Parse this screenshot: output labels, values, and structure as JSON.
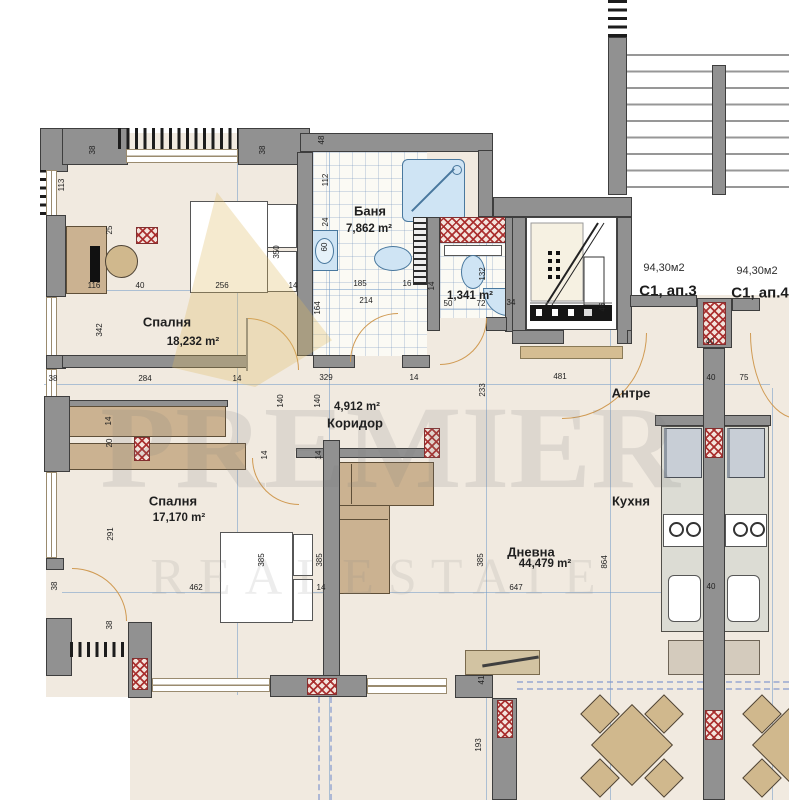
{
  "watermark": {
    "brand": "PREMIER",
    "tagline": "REALESTATE"
  },
  "apartments": [
    {
      "area": "94,30м2",
      "unit": "С1, ап.3"
    },
    {
      "area": "94,30м2",
      "unit": "С1, ап.4"
    }
  ],
  "rooms": [
    {
      "id": "bedroom-1",
      "name": "Спалня",
      "area": "18,232 m²"
    },
    {
      "id": "bathroom",
      "name": "Баня",
      "area": "7,862 m²"
    },
    {
      "id": "wc",
      "name": "",
      "area": "1,341 m²"
    },
    {
      "id": "corridor",
      "name": "Коридор",
      "area": "4,912 m²"
    },
    {
      "id": "bedroom-2",
      "name": "Спалня",
      "area": "17,170 m²"
    },
    {
      "id": "living-room",
      "name": "Дневна",
      "area": "44,479 m²"
    },
    {
      "id": "kitchen",
      "name": "Кухня",
      "area": ""
    },
    {
      "id": "entry",
      "name": "Антре",
      "area": ""
    }
  ],
  "colors": {
    "wall": "#919191",
    "floor": "#f1eae0",
    "hatch_red": "#a82a2a",
    "fixture_blue": "#cfe4f4",
    "furniture_tan": "#cbb291",
    "door_arc": "#d09a52",
    "guide_blue": "#739bc8",
    "watermark_gold": "#dfb95f"
  },
  "dimensions": [
    {
      "t": "38",
      "x": 93,
      "y": 150,
      "v": 1
    },
    {
      "t": "38",
      "x": 263,
      "y": 150,
      "v": 1
    },
    {
      "t": "48",
      "x": 322,
      "y": 140,
      "v": 1
    },
    {
      "t": "113",
      "x": 62,
      "y": 185,
      "v": 1
    },
    {
      "t": "25",
      "x": 110,
      "y": 230,
      "v": 1
    },
    {
      "t": "116",
      "x": 94,
      "y": 286
    },
    {
      "t": "40",
      "x": 140,
      "y": 286
    },
    {
      "t": "256",
      "x": 222,
      "y": 286
    },
    {
      "t": "350",
      "x": 277,
      "y": 252,
      "v": 1
    },
    {
      "t": "14",
      "x": 293,
      "y": 286
    },
    {
      "t": "342",
      "x": 100,
      "y": 330,
      "v": 1
    },
    {
      "t": "38",
      "x": 53,
      "y": 379
    },
    {
      "t": "284",
      "x": 145,
      "y": 379
    },
    {
      "t": "14",
      "x": 237,
      "y": 379
    },
    {
      "t": "329",
      "x": 326,
      "y": 378
    },
    {
      "t": "14",
      "x": 414,
      "y": 378
    },
    {
      "t": "481",
      "x": 560,
      "y": 377
    },
    {
      "t": "233",
      "x": 483,
      "y": 390,
      "v": 1
    },
    {
      "t": "40",
      "x": 711,
      "y": 378
    },
    {
      "t": "75",
      "x": 744,
      "y": 378
    },
    {
      "t": "112",
      "x": 326,
      "y": 180,
      "v": 1
    },
    {
      "t": "24",
      "x": 326,
      "y": 222,
      "v": 1
    },
    {
      "t": "60",
      "x": 325,
      "y": 247,
      "v": 1
    },
    {
      "t": "185",
      "x": 360,
      "y": 284
    },
    {
      "t": "16",
      "x": 407,
      "y": 284
    },
    {
      "t": "214",
      "x": 366,
      "y": 301
    },
    {
      "t": "132",
      "x": 483,
      "y": 274,
      "v": 1
    },
    {
      "t": "14",
      "x": 432,
      "y": 286,
      "v": 1
    },
    {
      "t": "50",
      "x": 448,
      "y": 304
    },
    {
      "t": "72",
      "x": 481,
      "y": 304
    },
    {
      "t": "34",
      "x": 511,
      "y": 303
    },
    {
      "t": "164",
      "x": 318,
      "y": 308,
      "v": 1
    },
    {
      "t": "46",
      "x": 603,
      "y": 307,
      "v": 1
    },
    {
      "t": "40",
      "x": 710,
      "y": 342
    },
    {
      "t": "140",
      "x": 281,
      "y": 401,
      "v": 1
    },
    {
      "t": "140",
      "x": 318,
      "y": 401,
      "v": 1
    },
    {
      "t": "14",
      "x": 109,
      "y": 421,
      "v": 1
    },
    {
      "t": "20",
      "x": 110,
      "y": 443,
      "v": 1
    },
    {
      "t": "14",
      "x": 265,
      "y": 455,
      "v": 1
    },
    {
      "t": "14",
      "x": 319,
      "y": 455,
      "v": 1
    },
    {
      "t": "291",
      "x": 111,
      "y": 534,
      "v": 1
    },
    {
      "t": "385",
      "x": 262,
      "y": 560,
      "v": 1
    },
    {
      "t": "385",
      "x": 320,
      "y": 560,
      "v": 1
    },
    {
      "t": "462",
      "x": 196,
      "y": 588
    },
    {
      "t": "14",
      "x": 321,
      "y": 588
    },
    {
      "t": "385",
      "x": 481,
      "y": 560,
      "v": 1
    },
    {
      "t": "864",
      "x": 605,
      "y": 562,
      "v": 1
    },
    {
      "t": "647",
      "x": 516,
      "y": 588
    },
    {
      "t": "38",
      "x": 55,
      "y": 586,
      "v": 1
    },
    {
      "t": "38",
      "x": 110,
      "y": 625,
      "v": 1
    },
    {
      "t": "41",
      "x": 482,
      "y": 680,
      "v": 1
    },
    {
      "t": "193",
      "x": 479,
      "y": 745,
      "v": 1
    },
    {
      "t": "40",
      "x": 711,
      "y": 587
    }
  ],
  "label_positions": {
    "bedroom1_name": {
      "x": 167,
      "y": 322
    },
    "bedroom1_area": {
      "x": 193,
      "y": 342
    },
    "bath_name": {
      "x": 370,
      "y": 211
    },
    "bath_area": {
      "x": 369,
      "y": 229
    },
    "wc_area": {
      "x": 470,
      "y": 296
    },
    "corridor_area": {
      "x": 357,
      "y": 407
    },
    "corridor_name": {
      "x": 355,
      "y": 423
    },
    "bedroom2_name": {
      "x": 173,
      "y": 501
    },
    "bedroom2_area": {
      "x": 179,
      "y": 518
    },
    "living_name": {
      "x": 531,
      "y": 552
    },
    "living_area": {
      "x": 545,
      "y": 564
    },
    "kitchen_name": {
      "x": 631,
      "y": 501
    },
    "entry_name": {
      "x": 631,
      "y": 393
    },
    "ap3_area": {
      "x": 664,
      "y": 268
    },
    "ap3_unit": {
      "x": 668,
      "y": 291
    },
    "ap4_area": {
      "x": 757,
      "y": 271
    },
    "ap4_unit": {
      "x": 760,
      "y": 293
    }
  }
}
